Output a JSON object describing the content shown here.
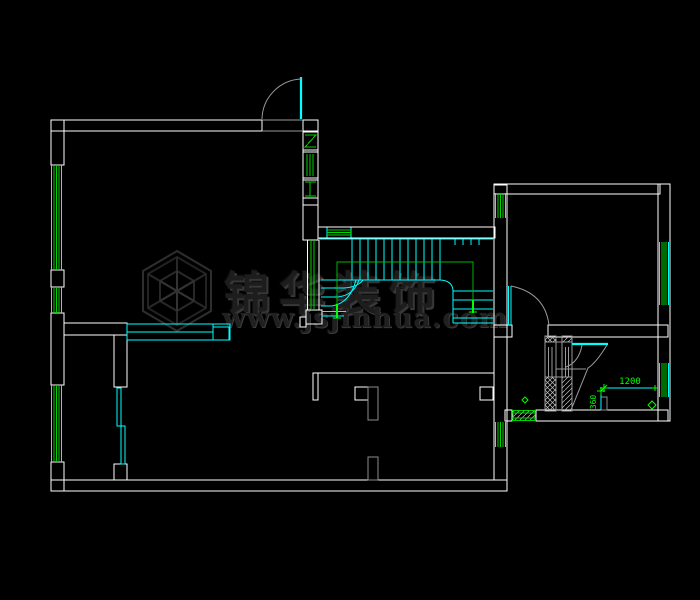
{
  "app": {
    "type": "cad-floor-plan-viewport",
    "background": "#000000"
  },
  "watermark": {
    "brand": "锦华装饰",
    "website": "www.jsjinhua.com",
    "logo": "hexagon-cube"
  },
  "annotations": {
    "dim_width": {
      "value": "1200"
    },
    "dim_depth": {
      "value": "360"
    }
  },
  "palette": {
    "wall": "#ffffff",
    "glazing": "#00ffff",
    "frame_green": "#00d200",
    "bright_green": "#00ff00",
    "swing_gray": "#9a9a9a",
    "jamb_gray": "#8c8c8c",
    "hatch_gray": "#c0c0c0",
    "dim_text": "#00ff00",
    "watermark_gray": "#2e2e2e"
  }
}
